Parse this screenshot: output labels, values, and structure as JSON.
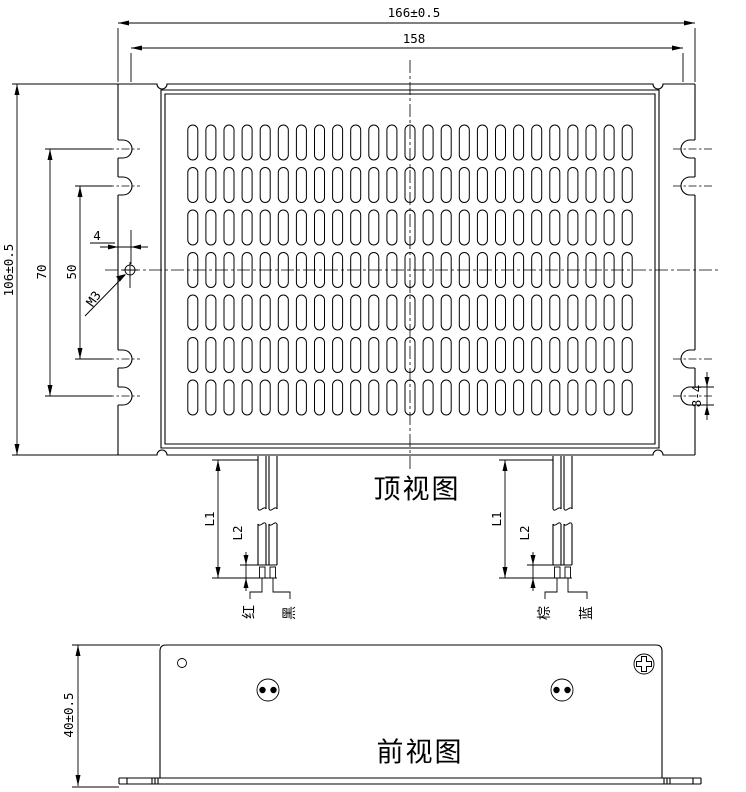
{
  "drawing": {
    "colors": {
      "line": "#000000",
      "background": "#ffffff"
    },
    "top_view": {
      "title": "顶视图",
      "dimensions": {
        "overall_width": "166±0.5",
        "mount_slot_span_width": "158",
        "overall_height": "106±0.5",
        "mount_slot_span_outer": "70",
        "mount_slot_span_inner": "50",
        "ground_hole_offset": "4",
        "ground_hole_thread": "M3",
        "mount_slot_size": "8-4",
        "wire_length": "L1",
        "wire_strip_length": "L2"
      },
      "wire_labels": {
        "left_pair": [
          "红",
          "黑"
        ],
        "right_pair": [
          "棕",
          "蓝"
        ]
      },
      "vents": {
        "rows": 7,
        "cols": 25,
        "row_pitch": 42.5,
        "col_pitch": 18.1,
        "first_row_y": 125,
        "center_x": 410,
        "slot_w": 10,
        "slot_h": 35
      }
    },
    "front_view": {
      "title": "前视图",
      "dimensions": {
        "overall_height": "40±0.5"
      }
    }
  }
}
